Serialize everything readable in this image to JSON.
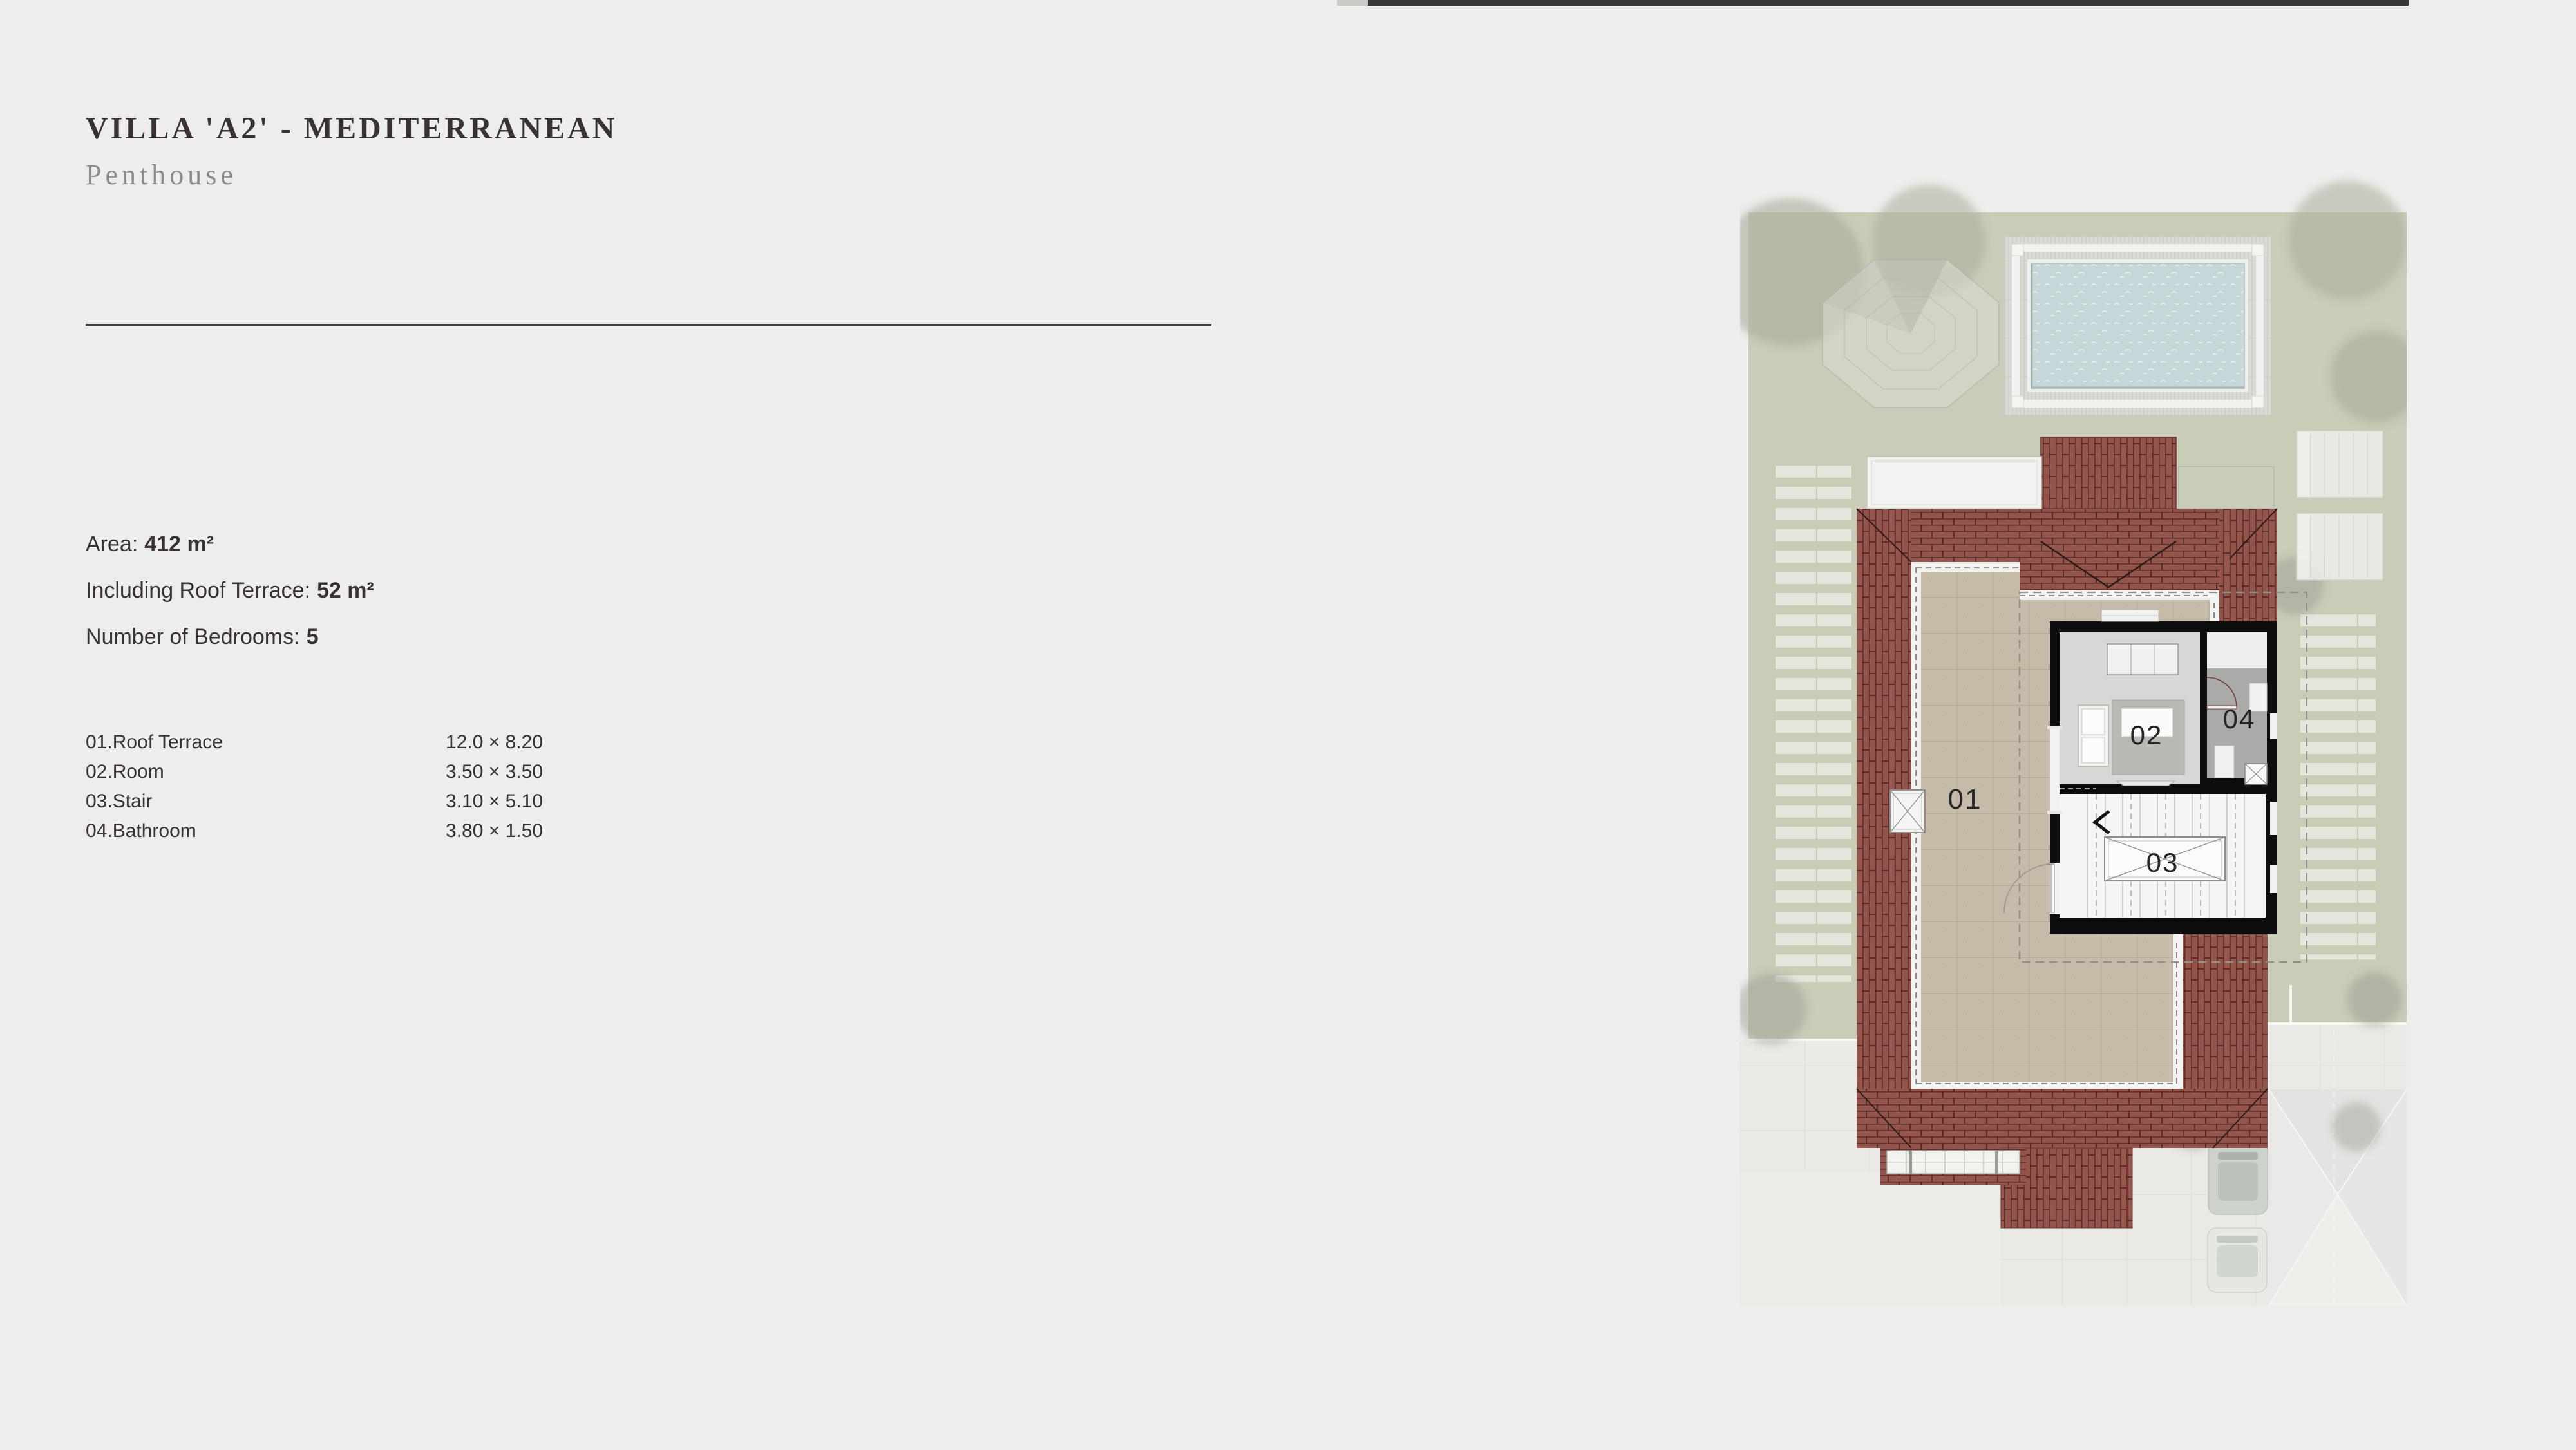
{
  "header": {
    "title": "VILLA 'A2' - MEDITERRANEAN",
    "subtitle": "Penthouse"
  },
  "details": [
    {
      "label": "Area:",
      "value": "412 m²"
    },
    {
      "label": "Including Roof Terrace:",
      "value": "52 m²"
    },
    {
      "label": "Number of Bedrooms:",
      "value": "5"
    }
  ],
  "room_schedule": [
    {
      "name": "01.Roof Terrace",
      "dimensions": "12.0 × 8.20"
    },
    {
      "name": "02.Room",
      "dimensions": "3.50 × 3.50"
    },
    {
      "name": "03.Stair",
      "dimensions": "3.10 × 5.10"
    },
    {
      "name": "04.Bathroom",
      "dimensions": "3.80 × 1.50"
    }
  ],
  "plan": {
    "labels": [
      "01",
      "02",
      "03",
      "04"
    ]
  },
  "colors": {
    "page_bg": "#edeeec",
    "text": "#3a3134",
    "subtitle": "#8c8c8a",
    "top_bar": "#393436",
    "garden_green": "#c9ccb7",
    "hedge_stripe": "#e7e8e0",
    "roof_tile": "#93544c",
    "terrace_floor": "#c6baa9",
    "pool_water": "#c5d7d9",
    "wall_black": "#0d0d0d",
    "room_floor": "#d7d8d5",
    "bathroom_floor": "#aaaaa8",
    "driveway": "#e9e9e6"
  }
}
